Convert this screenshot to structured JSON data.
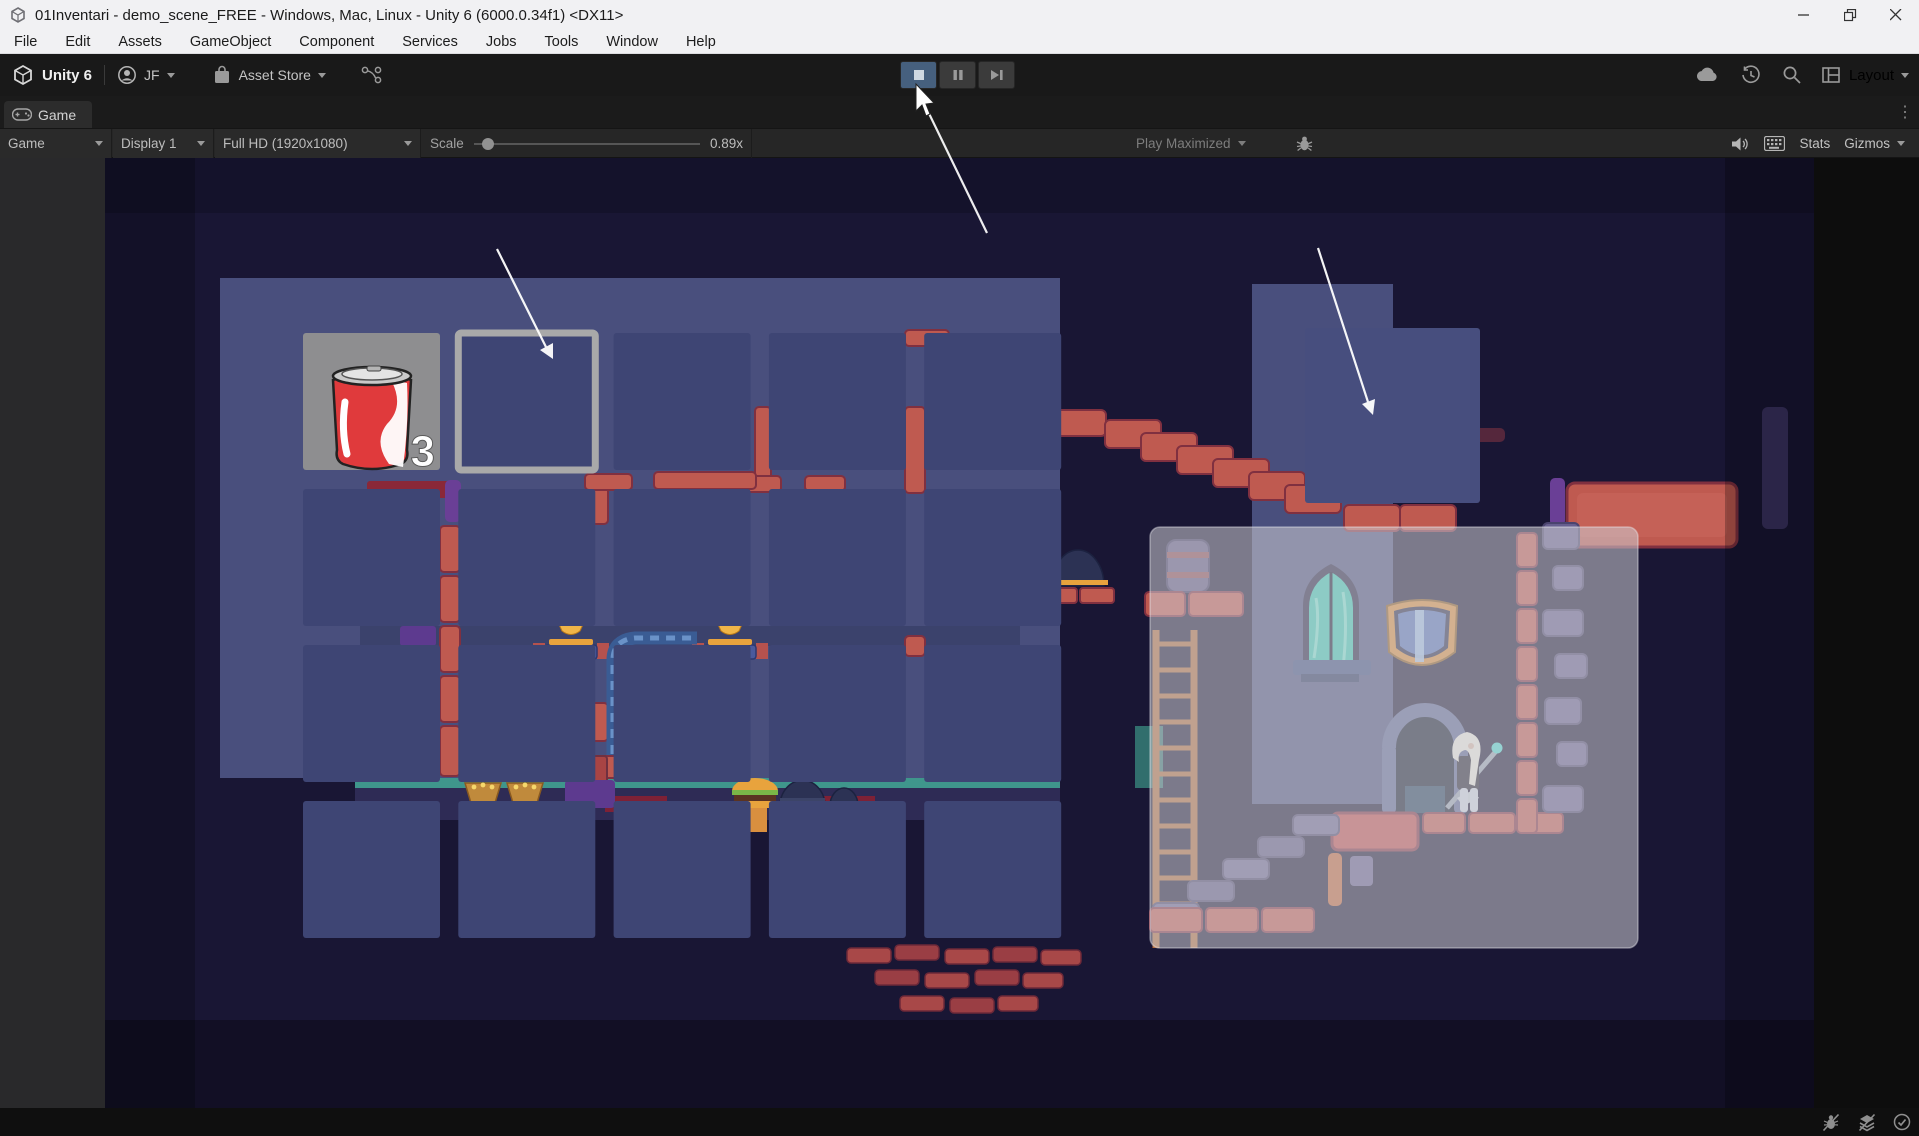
{
  "window": {
    "title": "01Inventari - demo_scene_FREE - Windows, Mac, Linux - Unity 6 (6000.0.34f1) <DX11>"
  },
  "menubar": {
    "items": [
      "File",
      "Edit",
      "Assets",
      "GameObject",
      "Component",
      "Services",
      "Jobs",
      "Tools",
      "Window",
      "Help"
    ]
  },
  "toolbar": {
    "product": "Unity 6",
    "account": "JF",
    "asset_store": "Asset Store",
    "layout": "Layout"
  },
  "tabbar": {
    "game_tab": "Game"
  },
  "gamebar": {
    "target": "Game",
    "display": "Display 1",
    "resolution": "Full HD (1920x1080)",
    "scale_label": "Scale",
    "scale_value": "0.89x",
    "play_maximized": "Play Maximized",
    "stats": "Stats",
    "gizmos": "Gizmos"
  },
  "inventory": {
    "cols": 5,
    "rows": 4,
    "selected_slot": 1,
    "item": {
      "slot": 0,
      "name": "soda-can",
      "count": "3"
    }
  },
  "colors": {
    "accent_play_active": "#46607e",
    "selected_slot_border": "#a9a9a9",
    "slot_fill": "#3e4574",
    "item_slot_fill": "#8e8e90",
    "room_wall": "#494f7d",
    "brick_red": "#bf5a50",
    "brick_dark_red": "#8a2838",
    "brick_purple": "#665e8e",
    "teal": "#3f968c",
    "gold": "#e8a33d",
    "panel_overlay": "rgba(206,206,212,0.55)"
  }
}
